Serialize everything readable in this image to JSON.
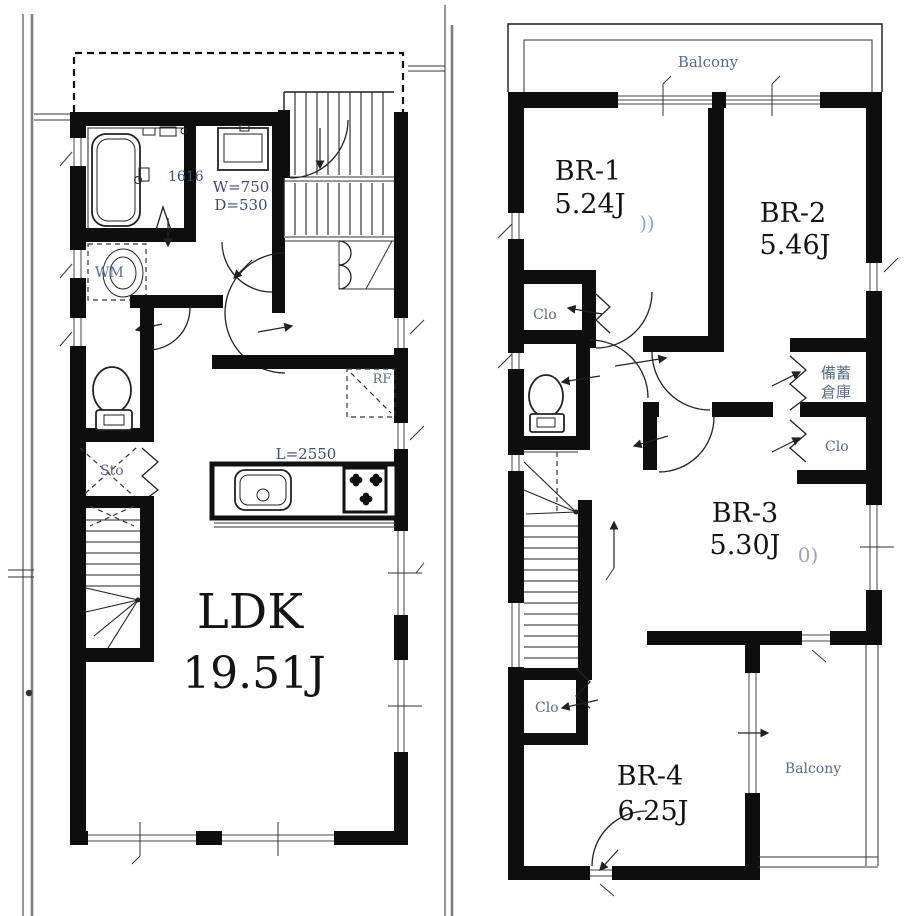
{
  "colors": {
    "wall": "#0e0e0e",
    "background": "#ffffff",
    "dimension_text": "#3d4d6b",
    "label_text": "#5b6a85",
    "faint_text": "#97a5c6",
    "room_text": "#141414",
    "boundary_gray": "#7d7d7d"
  },
  "floor1": {
    "room_ldk": {
      "name": "LDK",
      "size": "19.51J"
    },
    "bath_size_label": "1616",
    "vanity_width_label": "W=750",
    "vanity_depth_label": "D=530",
    "washing_machine_label": "WM",
    "storage_label": "Sto",
    "refrigerator_label": "RF",
    "kitchen_counter_label": "L=2550"
  },
  "floor2": {
    "balcony_top_label": "Balcony",
    "balcony_bottom_label": "Balcony",
    "room_br1": {
      "name": "BR-1",
      "size": "5.24J"
    },
    "room_br2": {
      "name": "BR-2",
      "size": "5.46J"
    },
    "room_br3": {
      "name": "BR-3",
      "size": "5.30J"
    },
    "room_br4": {
      "name": "BR-4",
      "size": "6.25J"
    },
    "closet1_label": "Clo",
    "closet2_label": "Clo",
    "closet3_label": "Clo",
    "storage_room_label_line1": "備蓄",
    "storage_room_label_line2": "倉庫",
    "mark_wave": "))",
    "mark_partial": "0)"
  }
}
